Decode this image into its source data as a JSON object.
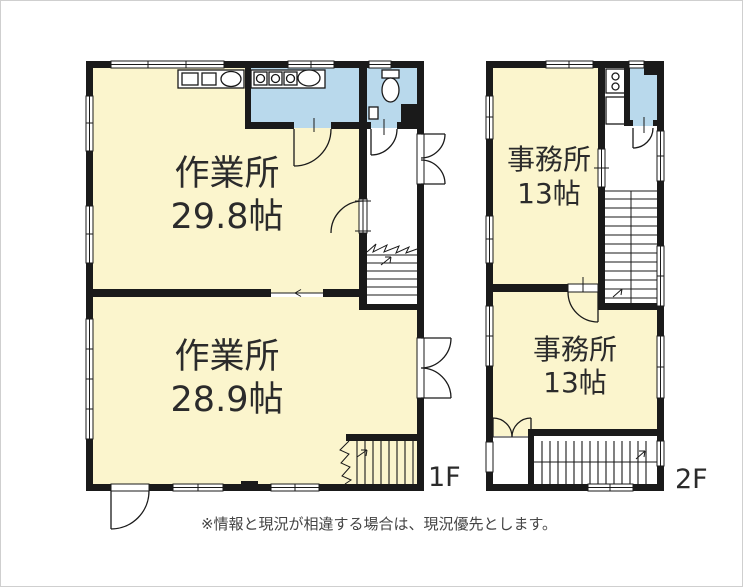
{
  "colors": {
    "room_fill": "#fbf5cd",
    "wet_fill": "#b9d9ec",
    "wall": "#1a1a1a",
    "text": "#2b2b2b",
    "note_text": "#444444"
  },
  "floors": {
    "f1": {
      "label": "1F",
      "rooms": [
        {
          "name": "作業所",
          "size": "29.8帖"
        },
        {
          "name": "作業所",
          "size": "28.9帖"
        }
      ]
    },
    "f2": {
      "label": "2F",
      "rooms": [
        {
          "name": "事務所",
          "size": "13帖"
        },
        {
          "name": "事務所",
          "size": "13帖"
        }
      ]
    }
  },
  "icons": [
    "toilet-icon",
    "stove-icon",
    "sink-icon",
    "washbasin-icon"
  ],
  "note": "※情報と現況が相違する場合は、現況優先とします。"
}
